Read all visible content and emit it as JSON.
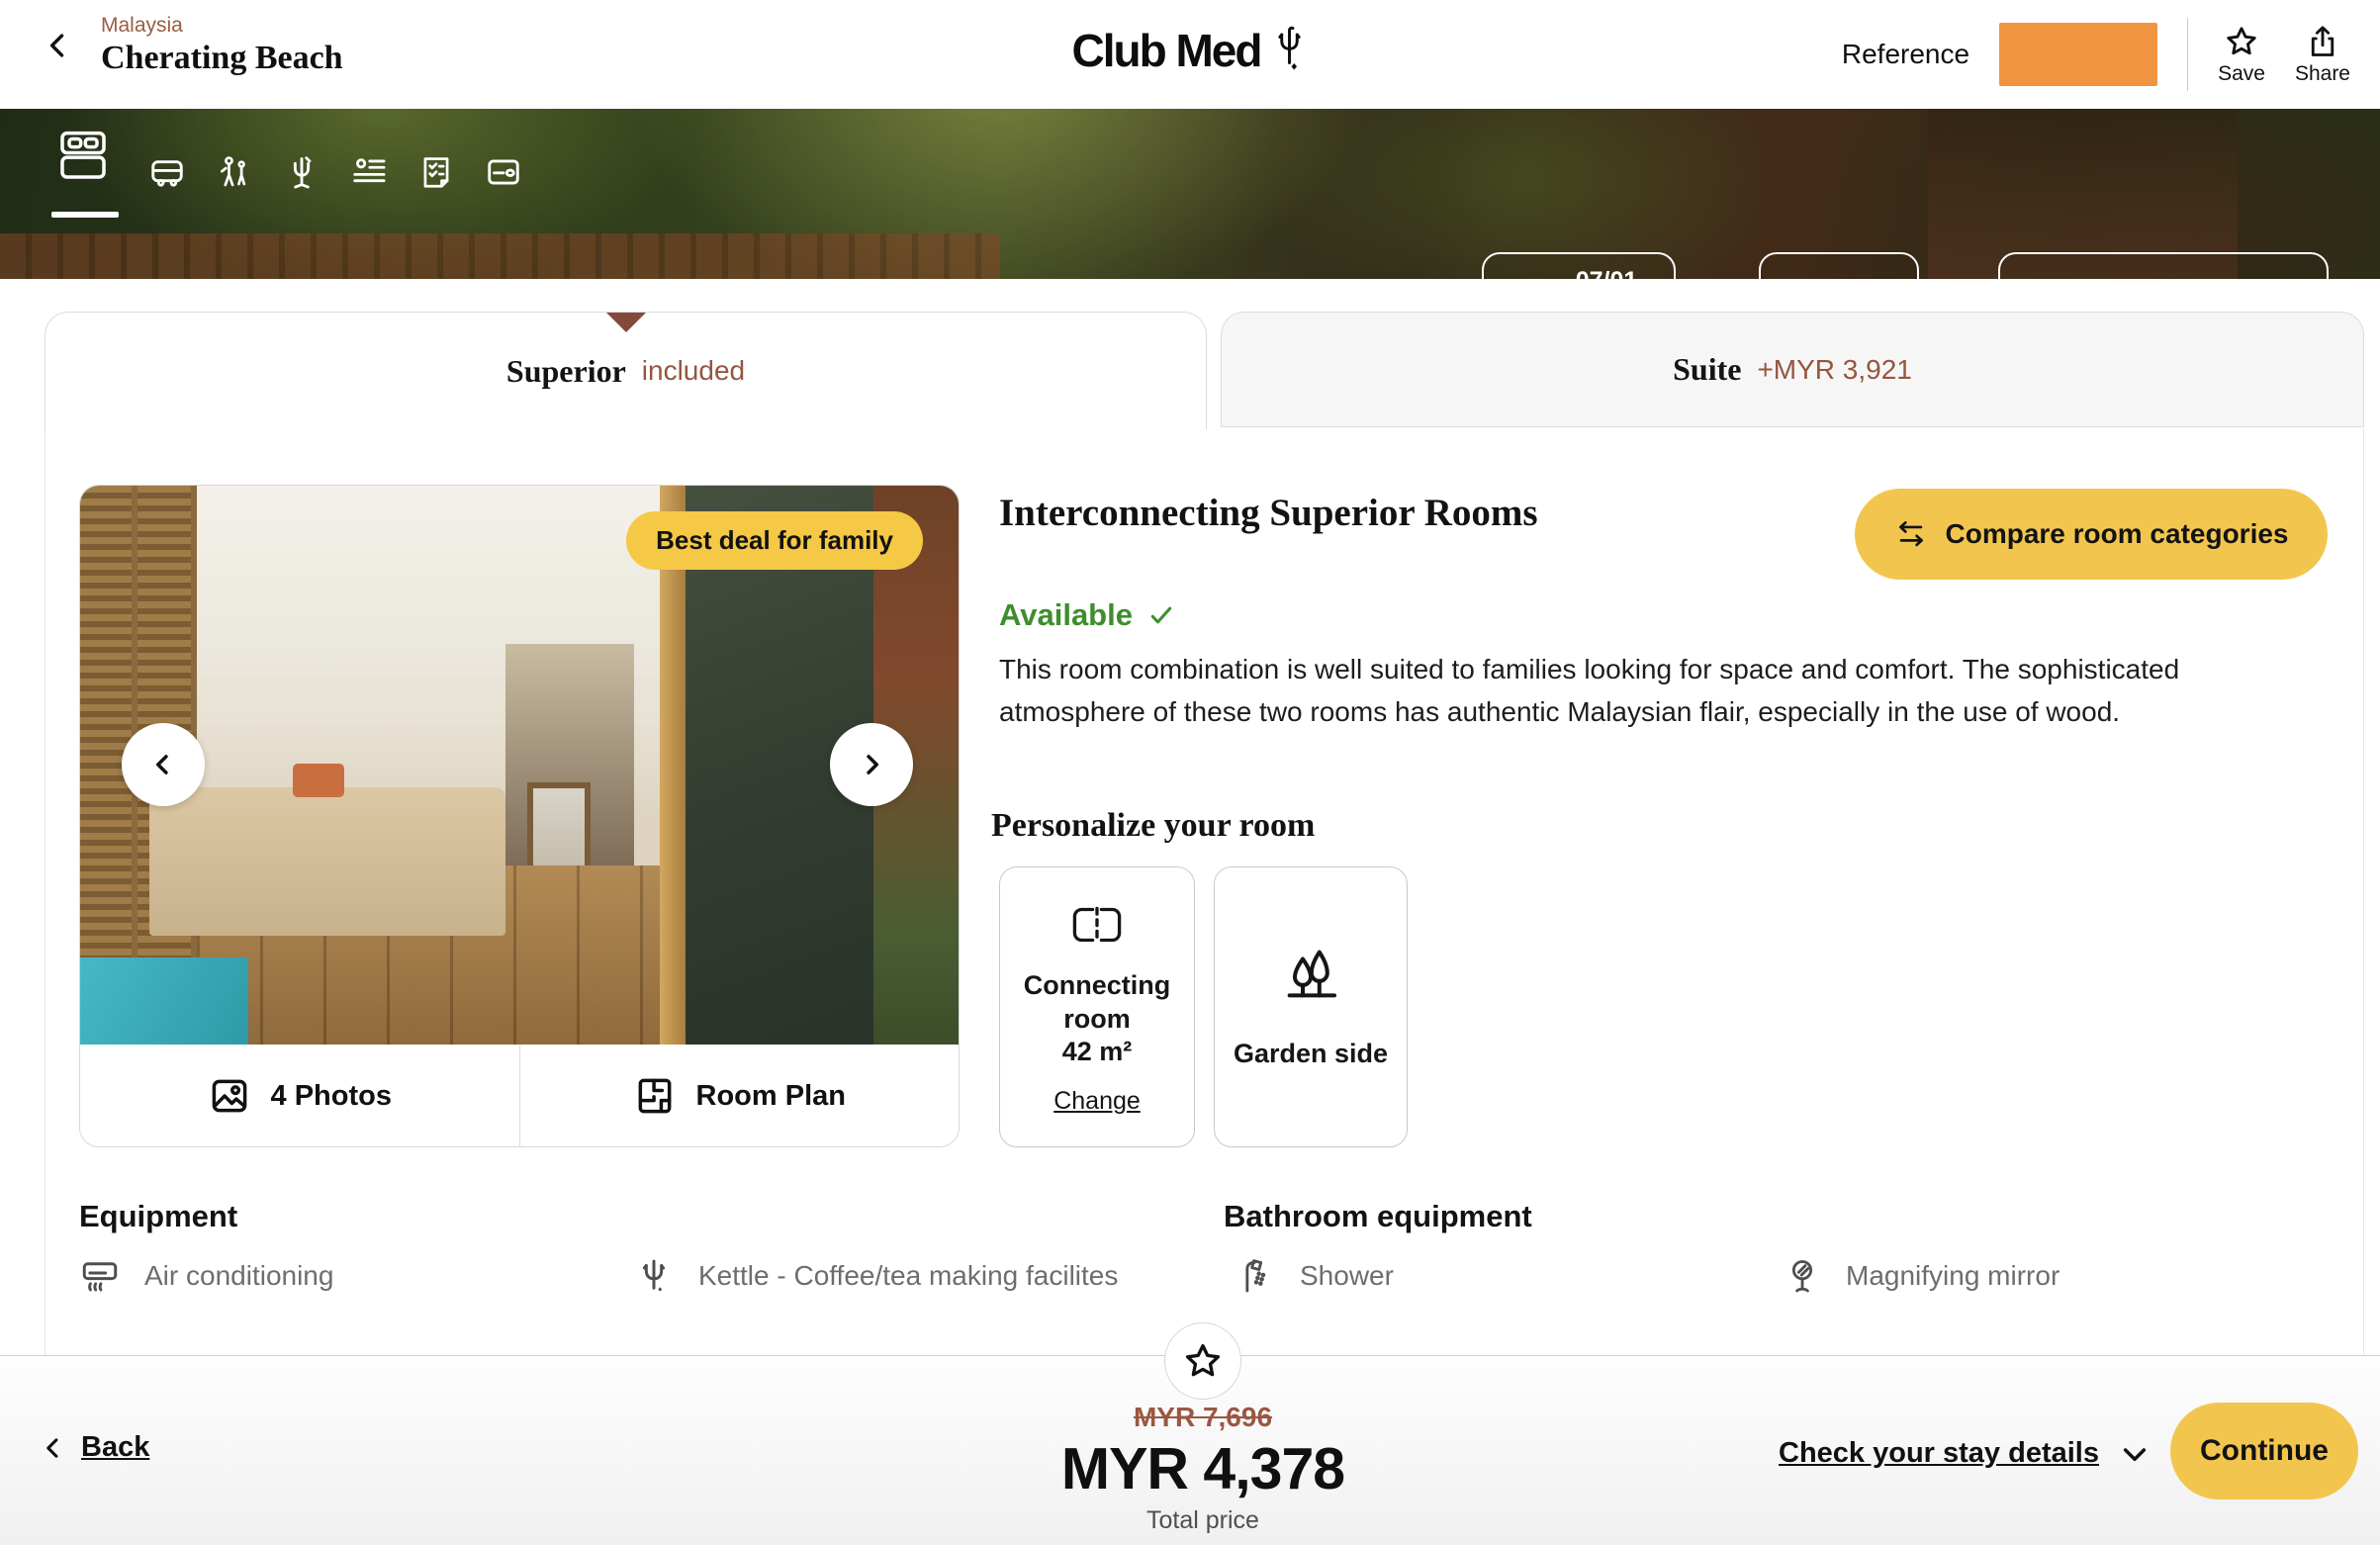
{
  "header": {
    "breadcrumb": "Malaysia",
    "title": "Cherating Beach",
    "logo_text": "Club Med",
    "reference_label": "Reference",
    "save_label": "Save",
    "share_label": "Share"
  },
  "stepper": {
    "step_indicator": "1/7",
    "step_label": "Accommodation",
    "steps": [
      "accommodation",
      "transport",
      "excursions",
      "activities",
      "guest-details",
      "summary",
      "payment"
    ],
    "date_start": "07/01",
    "date_end": "10/01",
    "guest_count": "4",
    "transport_label": "Without transport"
  },
  "tabs": {
    "superior": {
      "label": "Superior",
      "status": "included"
    },
    "suite": {
      "label": "Suite",
      "price_delta": "+MYR 3,921"
    }
  },
  "room": {
    "badge": "Best deal for family",
    "photos_label": "4 Photos",
    "room_plan_label": "Room Plan",
    "title": "Interconnecting Superior Rooms",
    "compare_label": "Compare room categories",
    "availability": "Available",
    "description": "This room combination is well suited to families looking for space and comfort. The sophisticated atmosphere of these two rooms has authentic Malaysian flair, especially in the use of wood."
  },
  "personalize": {
    "title": "Personalize your room",
    "connecting": {
      "label": "Connecting room",
      "size": "42 m²",
      "action": "Change",
      "icon": "connecting-room-icon"
    },
    "garden": {
      "label": "Garden side",
      "icon": "garden-trees-icon"
    }
  },
  "equipment": {
    "title": "Equipment",
    "items": [
      {
        "label": "Air conditioning",
        "icon": "air-conditioning-icon"
      },
      {
        "label": "Kettle - Coffee/tea making facilites",
        "icon": "kettle-trident-icon"
      }
    ]
  },
  "bathroom": {
    "title": "Bathroom equipment",
    "items": [
      {
        "label": "Shower",
        "icon": "shower-icon"
      },
      {
        "label": "Magnifying mirror",
        "icon": "magnifying-mirror-icon"
      }
    ]
  },
  "footer": {
    "back_label": "Back",
    "old_price": "MYR 7,696",
    "price": "MYR 4,378",
    "price_caption": "Total price",
    "details_label": "Check your stay details",
    "continue_label": "Continue"
  },
  "colors": {
    "accent_yellow": "#F2C64E",
    "badge_yellow": "#F5C845",
    "reference_orange": "#F0953F",
    "brand_brown": "#96553f",
    "available_green": "#3e8e2c"
  }
}
